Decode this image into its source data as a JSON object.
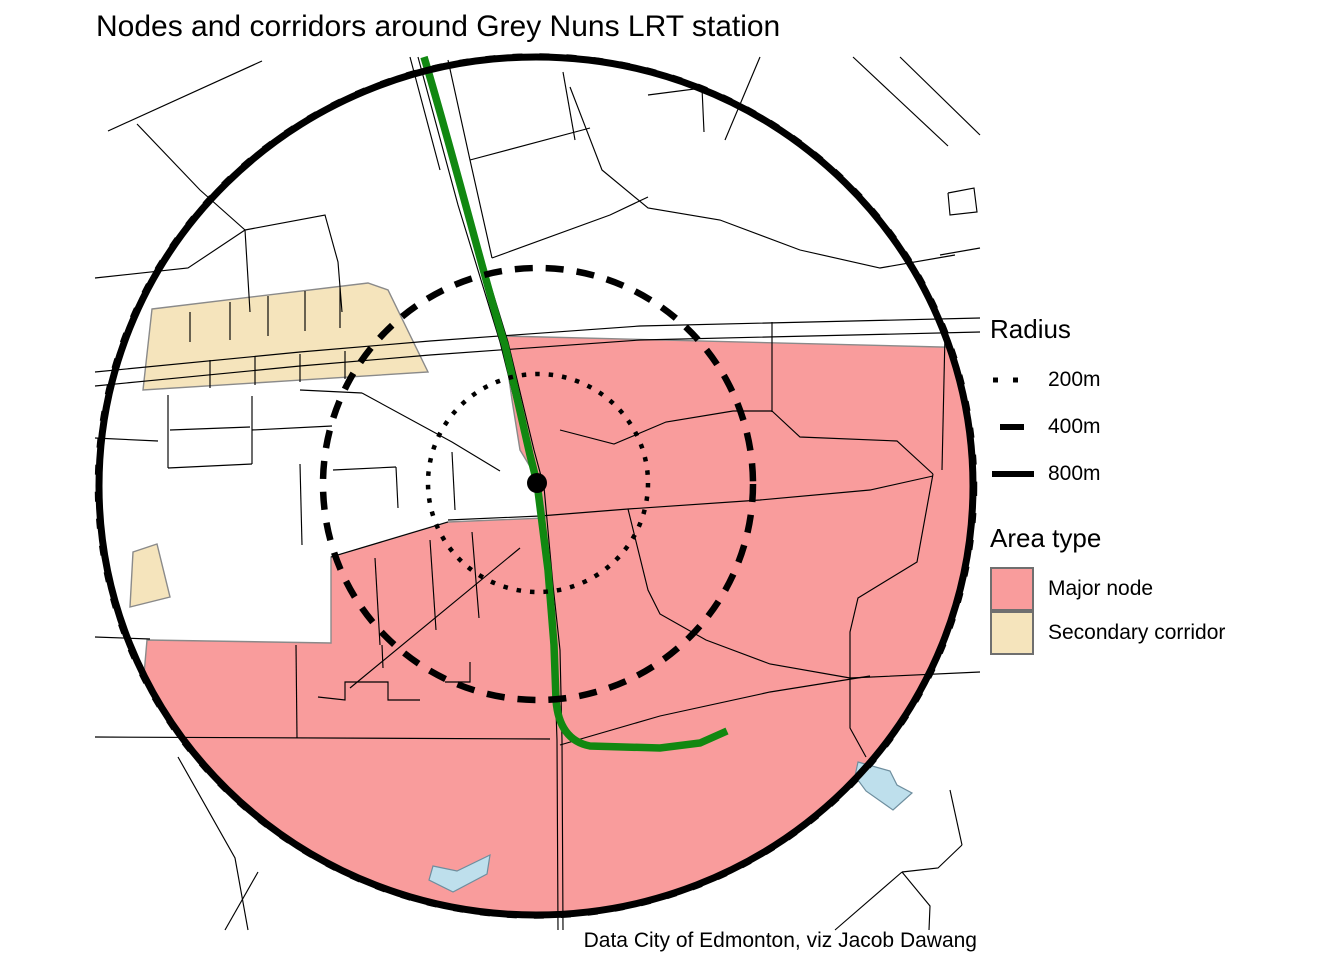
{
  "title": "Nodes and corridors around Grey Nuns LRT station",
  "caption": "Data City of Edmonton, viz Jacob Dawang",
  "legend": {
    "radius_title": "Radius",
    "radius_items": [
      {
        "label": "200m",
        "style": "dotted"
      },
      {
        "label": "400m",
        "style": "dashed"
      },
      {
        "label": "800m",
        "style": "solid"
      }
    ],
    "area_title": "Area type",
    "area_items": [
      {
        "label": "Major node",
        "color": "#F99C9C"
      },
      {
        "label": "Secondary corridor",
        "color": "#F5E4BC"
      }
    ]
  },
  "colors": {
    "major_node": "#F99C9C",
    "secondary_corridor": "#F5E4BC",
    "water": "#BEDFEC",
    "water_border": "#6E8E9E",
    "lrt_line": "#118811",
    "road": "#000000",
    "ring": "#000000",
    "area_border": "#8A8A8A",
    "station": "#000000"
  },
  "map": {
    "station": {
      "name": "Grey Nuns LRT station",
      "x": 537,
      "y": 483,
      "r": 10
    },
    "rings": [
      {
        "label": "200m",
        "cx": 538,
        "cy": 483,
        "rx": 110,
        "ry": 109,
        "width": 4.5,
        "dash": "4.5 9"
      },
      {
        "label": "400m",
        "cx": 538,
        "cy": 484,
        "rx": 215,
        "ry": 216,
        "width": 6.5,
        "dash": "18 13"
      },
      {
        "label": "800m",
        "cx": 536,
        "cy": 486,
        "rx": 437,
        "ry": 429,
        "width": 7,
        "dash": "none"
      },
      {
        "label": "800m-texture",
        "cx": 536,
        "cy": 486,
        "rx": 439,
        "ry": 430.5,
        "width": 4.5,
        "dash": "10 17"
      }
    ],
    "areas": {
      "major_node": [
        "503,336 980,348 980,950 120,950 147,640 331,643 331,557 448,522 545,518 540,483 520,450 512,400"
      ],
      "secondary_corridor": [
        "152,309 368,283 388,290 428,372 143,390",
        "130,607 133,552 157,544 170,597"
      ]
    },
    "water": [
      "858,762 890,771 897,785 912,793 893,810 866,791 855,776",
      "433,866 457,871 490,855 487,874 453,892 429,880"
    ],
    "lrt_path": "M424,57 C455,160 490,300 505,345 L530,455 537,483 548,570 554,645 556,700 Q559,740 590,746 L660,748 700,743 727,731",
    "roads": [
      "95,372 300,352 430,341 640,326 980,318",
      "95,386 300,366 430,355 640,340 980,332",
      "418,57 458,205 500,342 527,450 537,483 548,585 554,650 557,740 558,930",
      "426,57 466,205 508,342 534,450 544,487 553,585 560,650 562,740 563,930",
      "410,57 440,170",
      "108,131 262,61",
      "137,124 200,190 245,230 250,312",
      "95,278 188,268 245,230",
      "245,230 325,215 338,262 342,312",
      "190,312 190,342",
      "230,302 230,340",
      "268,296 268,336",
      "305,291 305,331",
      "340,288 340,328",
      "210,360 210,388",
      "255,357 255,385",
      "300,354 300,382",
      "345,351 345,379",
      "95,438 158,441",
      "448,60 470,160 492,258",
      "563,72 575,140",
      "470,160 590,128",
      "492,258 610,215 648,197",
      "570,87 602,170 648,208 720,220 800,250 880,268 955,255",
      "648,95 702,88 704,132",
      "760,57 725,140",
      "853,57 948,146",
      "900,57 980,135",
      "948,193 974,188 977,212 950,215 948,193",
      "940,255 980,248",
      "772,322 772,412",
      "560,430 614,444 666,422 733,411 772,411",
      "772,411 800,437 897,441 933,474",
      "933,474 917,562 858,598 850,632 850,728 866,757",
      "945,334 942,470",
      "448,520 540,516 628,509 760,500 870,490 933,476",
      "628,509 648,590 660,614 706,640 770,664 850,678 980,672",
      "560,745 660,716 770,692 870,676",
      "95,637 150,639",
      "95,737 550,739",
      "350,688 520,548",
      "331,557 448,522",
      "375,558 380,645",
      "430,540 436,630",
      "472,532 479,618",
      "296,645 297,738",
      "382,645 383,668",
      "318,697 345,700 345,682 388,682 388,700 420,700",
      "445,682 470,682 470,662",
      "178,757 235,858 248,930",
      "225,930 258,872",
      "950,790 962,845",
      "962,845 938,868 902,872",
      "902,872 930,906 929,930",
      "835,930 902,872",
      "300,390 362,393",
      "362,393 452,442 500,471",
      "333,470 396,467",
      "396,467 398,508",
      "452,452 455,510",
      "168,395 168,468",
      "168,468 252,464",
      "252,464 252,396",
      "170,430 250,427",
      "252,430 332,426",
      "300,464 302,545"
    ]
  }
}
